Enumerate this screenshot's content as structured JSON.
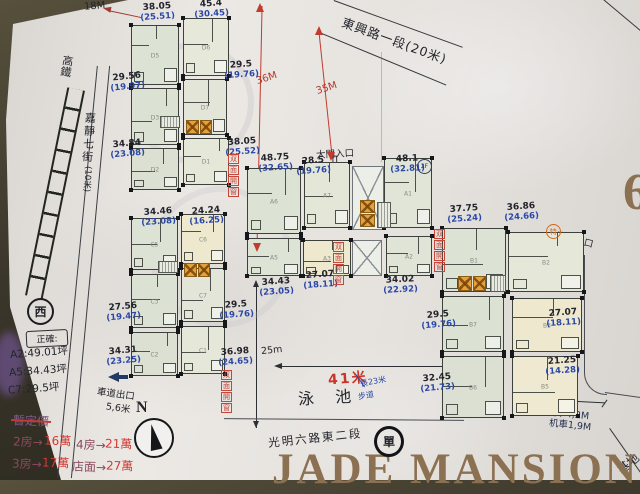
{
  "roads": {
    "top_street": "東興路一段(20米)",
    "left_street": "嘉靜七街",
    "left_street_width": "(10米)",
    "rail": "高鐵",
    "bottom_street": "光明六路東二段",
    "one_way": "單",
    "west": "西"
  },
  "dims": {
    "d18": "18M",
    "d36": "36M",
    "d35": "35M",
    "d25": "25m",
    "d41": "41米",
    "car": "汽車4,2M",
    "moto": "机車1,9M",
    "drive_exit": "車道出口",
    "drive_exit_width": "5,6米",
    "main_gate": "大門入口",
    "drive_entry": "車道入口"
  },
  "pool": {
    "name": "泳 池",
    "length": "長23米",
    "walkway": "步道"
  },
  "notes": {
    "box_title": "正確:",
    "areas": [
      "A2:49.01坪",
      "A5:34.43坪",
      "C7:29.5坪"
    ],
    "crossed_out": "暫定價",
    "window_note": "双面開窗",
    "special": "特",
    "a1_badge": "2F"
  },
  "prices": [
    {
      "label": "2房→",
      "value": "16萬"
    },
    {
      "label": "4房→",
      "value": "21萬"
    },
    {
      "label": "3房→",
      "value": "17萬"
    },
    {
      "label": "店面→",
      "value": "27萬"
    }
  ],
  "compass": {
    "north": "N"
  },
  "brand": {
    "name": "JADE MANSION",
    "big_digit": "6",
    "site": "基地"
  },
  "blocks": {
    "D": [
      {
        "id": "D5",
        "area": "38.05",
        "net": "(25.51)"
      },
      {
        "id": "D6",
        "area": "45.4",
        "net": "(30.45)"
      },
      {
        "id": "D3",
        "area": "29.56",
        "net": "(19.97)"
      },
      {
        "id": "D7",
        "area": "29.5",
        "net": "(19.76)"
      },
      {
        "id": "D2",
        "area": "34.84",
        "net": "(23.08)"
      },
      {
        "id": "D1",
        "area": "38.05",
        "net": "(25.52)"
      }
    ],
    "C": [
      {
        "id": "C5",
        "area": "34.46",
        "net": "(23.08)"
      },
      {
        "id": "C6",
        "area": "24.24",
        "net": "(16.25)"
      },
      {
        "id": "C3",
        "area": "27.56",
        "net": "(19.47)"
      },
      {
        "id": "C7",
        "area": "29.5",
        "net": "(19.76)"
      },
      {
        "id": "C2",
        "area": "34.31",
        "net": "(23.25)"
      },
      {
        "id": "C1",
        "area": "36.98",
        "net": "(24.65)"
      }
    ],
    "A": [
      {
        "id": "A6",
        "area": "48.75",
        "net": "(32.65)"
      },
      {
        "id": "A7",
        "area": "28.5",
        "net": "(19.76)"
      },
      {
        "id": "A1",
        "area": "48.1",
        "net": "(32.81)"
      },
      {
        "id": "A5",
        "area": "34.43",
        "net": "(23.05)"
      },
      {
        "id": "A3",
        "area": "27.07",
        "net": "(18.11)"
      },
      {
        "id": "A2",
        "area": "34.02",
        "net": "(22.92)"
      }
    ],
    "B": [
      {
        "id": "B1",
        "area": "37.75",
        "net": "(25.24)"
      },
      {
        "id": "B2",
        "area": "36.86",
        "net": "(24.66)"
      },
      {
        "id": "B7",
        "area": "29.5",
        "net": "(19.76)"
      },
      {
        "id": "B3",
        "area": "27.07",
        "net": "(18.11)"
      },
      {
        "id": "B6",
        "area": "32.45",
        "net": "(21.73)"
      },
      {
        "id": "B5",
        "area": "21.25",
        "net": "(14.28)"
      }
    ]
  }
}
